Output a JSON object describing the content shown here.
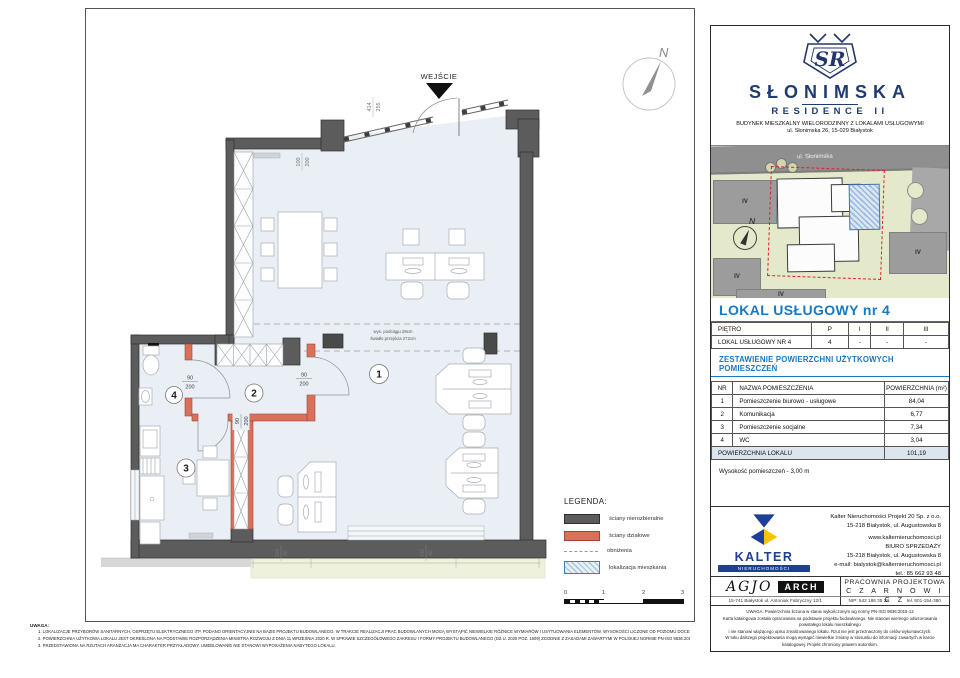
{
  "header": {
    "monogram": "SR",
    "brand_line1": "SŁONIMSKA",
    "brand_line2": "RESIDENCE II",
    "building_desc": "BUDYNEK MIESZKALNY WIELORODZINNY Z LOKALAMI USŁUGOWYMI",
    "address": "ul. Słonimska 26, 15-029 Białystok"
  },
  "site_map": {
    "street_label": "ul. Słonimska",
    "north_label": "N",
    "building_labels": [
      "IV",
      "IV",
      "IV",
      "IV"
    ]
  },
  "unit": {
    "title": "LOKAL USŁUGOWY  nr 4",
    "floor_table": {
      "header": [
        "PIĘTRO",
        "P",
        "I",
        "II",
        "III"
      ],
      "row": [
        "LOKAL USŁUGOWY NR 4",
        "4",
        "-",
        "-",
        "-"
      ]
    },
    "areas_heading": "ZESTAWIENIE POWIERZCHNI UŻYTKOWYCH POMIESZCZEŃ",
    "areas_table": {
      "columns": [
        "NR",
        "NAZWA POMIESZCZENIA",
        "POWIERZCHNIA (m²)"
      ],
      "rows": [
        {
          "nr": "1",
          "name": "Pomieszczenie biurowo - usługowe",
          "area": "84,04"
        },
        {
          "nr": "2",
          "name": "Komunikacja",
          "area": "6,77"
        },
        {
          "nr": "3",
          "name": "Pomieszczenie socjalne",
          "area": "7,34"
        },
        {
          "nr": "4",
          "name": "WC",
          "area": "3,04"
        }
      ],
      "total_label": "POWIERZCHNIA LOKALU",
      "total_value": "101,19"
    },
    "height_note": "Wysokość pomieszczeń - 3,00 m"
  },
  "plan": {
    "entrance_label": "WEJŚCIE",
    "north_label": "N",
    "rooms": [
      "1",
      "2",
      "3",
      "4"
    ],
    "beam_line1": "wys. podciągu 28cm",
    "beam_line2": "światło przejścia 272cm",
    "dims": {
      "door_w": "90",
      "door_h": "200",
      "entry_w": "414",
      "entry_h": "255",
      "window_w": "100",
      "window_h": "200",
      "sill1_w": "200",
      "sill1_h": "60",
      "sill2_w": "430",
      "sill2_h": "60"
    }
  },
  "legend": {
    "title": "LEGENDA:",
    "items": [
      {
        "label": "ściany nierozbieralne"
      },
      {
        "label": "ściany działowe"
      },
      {
        "label": "obniżenia"
      },
      {
        "label": "lokalizacja mieszkania"
      }
    ],
    "scale_ticks": [
      "0",
      "1",
      "2",
      "3"
    ]
  },
  "notes": {
    "title": "UWAGA:",
    "items": [
      "1.    LOKALIZACJE PRZYBORÓW SANITARNYCH, OSPRZĘTU ELEKTRYCZNEGO ITP. PODANO ORIENTACYJNIE NA BAZIE PROJEKTU BUDOWLANEGO. W TRAKCIE REALIZACJI PRAC BUDOWLANYCH MOGĄ WYSTĄPIĆ NIEWIELKIE RÓŻNICE WYMIARÓW I USYTUOWANIA ELEMENTÓW. WYSOKOŚCI LICZONE OD POZIOMU DOCELOWEGO WYKOŃCZENIA PODŁÓG.",
      "2.    POWIERZCHNIA UŻYTKOWA LOKALU JEST OKREŚLONA NA PODSTAWIE ROZPORZĄDZENIA MINISTRA ROZWOJU Z DNIA 11 WRZEŚNIA 2020 R. W SPRAWIE SZCZEGÓŁOWEGO ZAKRESU I FORMY PROJEKTU BUDOWLANEGO (DZ.U. 2020 POZ. 1609) ZGODNIE Z ZASADAMI ZAWARTYMI W POLSKIEJ NORMIE PN-ISO 9836:2015-12.",
      "3.    PRZEDSTAWIONA NA RZUTACH ARANŻACJA MA CHARAKTER PRZYKŁADOWY. UMEBLOWANIE NIE STANOWI WYPOSAŻENIA NABYTEGO LOKALU."
    ]
  },
  "kalter": {
    "name": "KALTER",
    "sub": "NIERUCHOMOŚCI",
    "lines": [
      "Kalter Nieruchomości Projekt 20  Sp. z o.o.",
      "15-218 Białystok, ul. Augustowska 8",
      "www.kalternieruchomosci.pl",
      "BIURO SPRZEDAŻY",
      "15-218 Białystok, ul. Augustowska 8",
      "e-mail: bialystok@kalternieruchomosci.pl",
      "tel.: 85 662 93 48"
    ]
  },
  "studio": {
    "agjo": "AGJO",
    "arch": "ARCH",
    "address": "15-741 Białystok    ul. Antoniuk Fabryczny  12/1",
    "name1": "PRACOWNIA PROJEKTOWA",
    "name2": "C Z A R N O W I C Z",
    "nip": "NIP:  542 186 35 28",
    "tel": "tel. 501-154-380"
  },
  "fine_print": {
    "lines": [
      "UWAGA:  Powierzchnia liczona w stanie wykończonym wg normy PN-ISO 9836:2015-12",
      "Karta katalogowa została opracowana na podstawie projektu budowlanego.  Nie stanowi wiernego odwzorowania powstałego lokalu mieszkalnego",
      "i nie stanowi wiążącego opisu zrealizowanego lokalu. Rzut nie jest przeznaczony do celów wykonawczych.",
      "W toku dalszego projektowania mogą wystąpić niewielkie zmiany w stosunku do informacji zawartych w karcie katalogowej. Projekt chroniony prawem autorskim."
    ]
  },
  "colors": {
    "accent_blue": "#1779c4",
    "brand_navy": "#1e3c72",
    "wall_gray": "#5c5c5c",
    "partition_red": "#d9705a"
  }
}
